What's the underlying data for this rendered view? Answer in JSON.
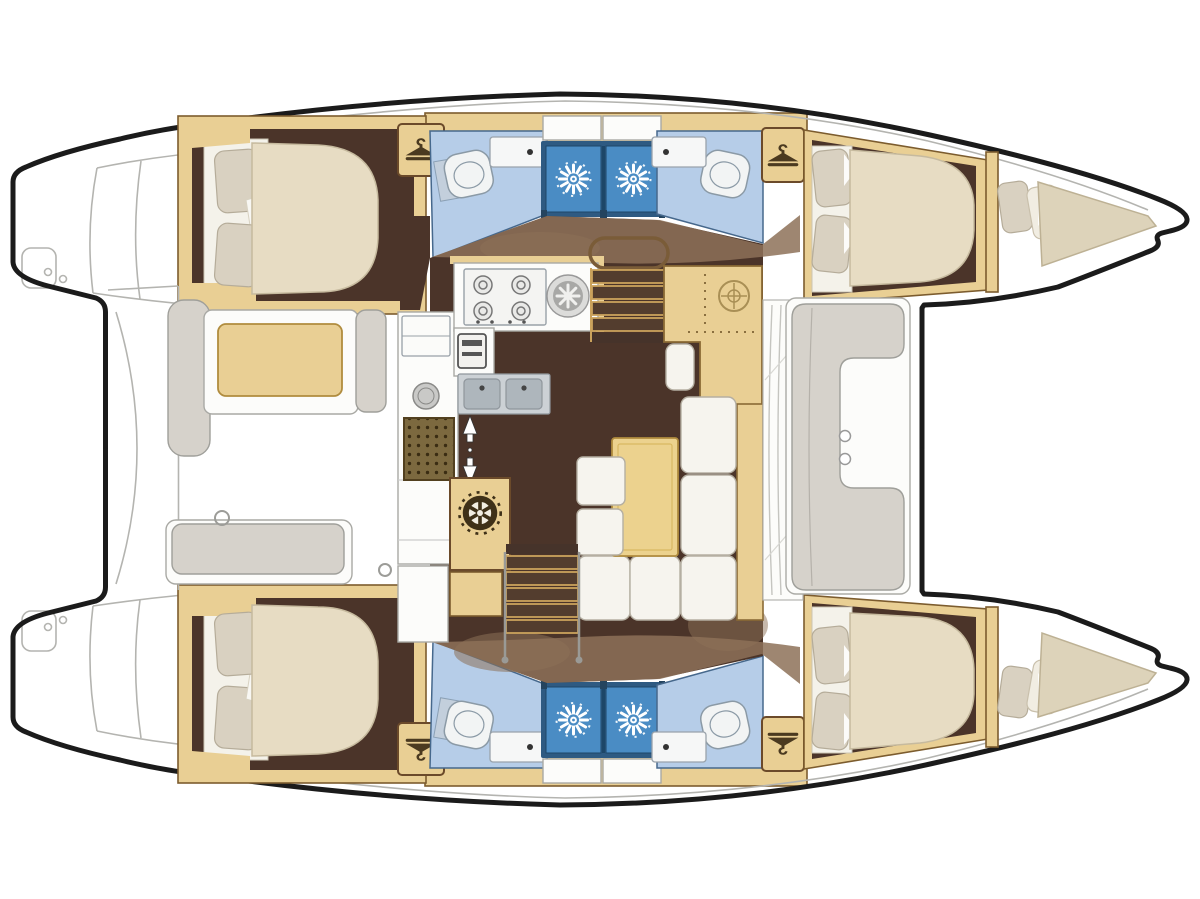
{
  "meta": {
    "title": "Catamaran yacht interior floor plan, top view, bow to the right",
    "type": "floor-plan",
    "figure": "4-cabin / 4-head sailing catamaran layout with central salon and galley"
  },
  "palette": {
    "hull_outline": "#1b1b1b",
    "deck_line": "#b4b4b0",
    "tan": "#e9cf94",
    "tan_dark": "#caa25c",
    "tan_border": "#7c5c2e",
    "wood_floor": "#4b3429",
    "wood_mid": "#533d2e",
    "wood_light": "#8d7158",
    "bath_floor": "#b6cde8",
    "bath_border": "#46688c",
    "shower_frame": "#2e5a82",
    "shower_fill": "#4a8cc4",
    "mattress": "#e7dcc3",
    "pillow": "#d9d1c1",
    "cushion": "#f6f4ee",
    "cushion_border": "#b5afa2",
    "bench_gray": "#d6d2cb",
    "bench_border": "#9f9f9a",
    "table": "#ecd28e",
    "steel": "#ccd1d5",
    "steel_dark": "#aeb6bc",
    "icon_dark": "#4b3a20",
    "white": "#fcfcfa"
  },
  "icons": {
    "hanger": {
      "meaning": "wardrobe / clothes hanger",
      "count": 4
    },
    "shower_rose": {
      "meaning": "shower stall head",
      "count": 4
    },
    "ship_wheel": {
      "meaning": "helm / wheel locker",
      "count": 2
    },
    "stove": {
      "meaning": "galley hob",
      "burners": 4
    },
    "companionway_arrows": {
      "meaning": "steps up / down",
      "direction": "up-down"
    }
  },
  "rooms": {
    "cabins": [
      "aft-port-double",
      "forward-port-double",
      "aft-starboard-double",
      "forward-starboard-double"
    ],
    "heads": 4,
    "shower_stalls": 4,
    "forepeak_berths": 2,
    "salon": [
      "galley",
      "dinette",
      "chart-table"
    ],
    "decks": [
      "aft-cockpit",
      "forward-cockpit",
      "transom-steps-port",
      "transom-steps-starboard"
    ]
  }
}
